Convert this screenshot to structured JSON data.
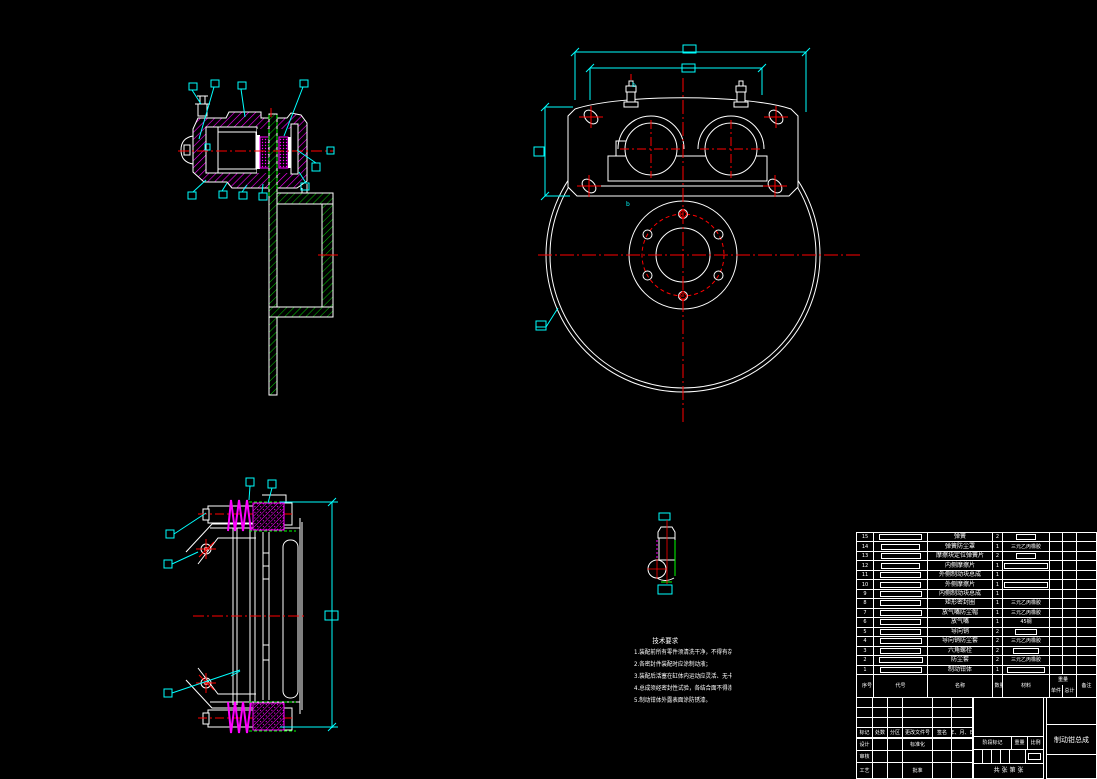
{
  "drawing": {
    "part_title": "制动钳总成",
    "section_mark": "b",
    "technical_notes": [
      "技术要求",
      "1.装配前所有零件须清洗干净，不得有杂质污物；",
      "2.各密封件装配时应涂制动液；",
      "3.装配后活塞在缸体内运动应灵活、无卡滞；",
      "4.总成须经密封性试验，各结合面不得渗漏；",
      "5.制动钳体外露表面涂防锈漆。"
    ]
  },
  "parts_table": {
    "headers": {
      "seq": "序号",
      "code": "代号",
      "name": "名称",
      "qty": "数量",
      "material": "材料",
      "weight": "重量",
      "unit": "单件",
      "total": "总计",
      "remark": "备注"
    },
    "rows": [
      {
        "seq": "15",
        "name": "弹簧",
        "qty": "2",
        "material": "",
        "material_box": 18,
        "code_box": 41
      },
      {
        "seq": "14",
        "name": "弹簧防尘罩",
        "qty": "1",
        "material": "三元乙丙橡胶",
        "material_box": 0,
        "code_box": 37
      },
      {
        "seq": "13",
        "name": "摩擦块定位弹簧片",
        "qty": "2",
        "material": "",
        "material_box": 18,
        "code_box": 38
      },
      {
        "seq": "12",
        "name": "内侧摩擦片",
        "qty": "1",
        "material": "",
        "material_box": 42,
        "code_box": 37
      },
      {
        "seq": "11",
        "name": "外侧制动块总成",
        "qty": "1",
        "material": "",
        "material_box": 0,
        "code_box": 39
      },
      {
        "seq": "10",
        "name": "外侧摩擦片",
        "qty": "1",
        "material": "",
        "material_box": 42,
        "code_box": 39
      },
      {
        "seq": "9",
        "name": "内侧制动块总成",
        "qty": "1",
        "material": "",
        "material_box": 0,
        "code_box": 40
      },
      {
        "seq": "8",
        "name": "矩形密封圈",
        "qty": "1",
        "material": "三元乙丙橡胶",
        "material_box": 0,
        "code_box": 39
      },
      {
        "seq": "7",
        "name": "放气嘴防尘帽",
        "qty": "1",
        "material": "三元乙丙橡胶",
        "material_box": 0,
        "code_box": 40
      },
      {
        "seq": "6",
        "name": "放气嘴",
        "qty": "1",
        "material": "45钢",
        "material_box": 0,
        "code_box": 39
      },
      {
        "seq": "5",
        "name": "导向销",
        "qty": "2",
        "material": "",
        "material_box": 20,
        "code_box": 39
      },
      {
        "seq": "4",
        "name": "导向销防尘套",
        "qty": "2",
        "material": "三元乙丙橡胶",
        "material_box": 0,
        "code_box": 40
      },
      {
        "seq": "3",
        "name": "六角螺栓",
        "qty": "2",
        "material": "",
        "material_box": 24,
        "code_box": 39
      },
      {
        "seq": "2",
        "name": "防尘套",
        "qty": "2",
        "material": "三元乙丙橡胶",
        "material_box": 0,
        "code_box": 42
      },
      {
        "seq": "1",
        "name": "制动钳体",
        "qty": "1",
        "material": "",
        "material_box": 36,
        "code_box": 40
      }
    ]
  },
  "title_block": {
    "revision_headers": [
      "标记",
      "处数",
      "分区",
      "更改文件号",
      "签名",
      "年、月、日"
    ],
    "design": "设计",
    "check": "审核",
    "process": "工艺",
    "standard": "标准化",
    "approve": "批准",
    "stage_mark": "阶段标记",
    "weight": "重量",
    "scale": "比例",
    "sheets": "共 张 第 张",
    "part_name": "制动钳总成"
  }
}
